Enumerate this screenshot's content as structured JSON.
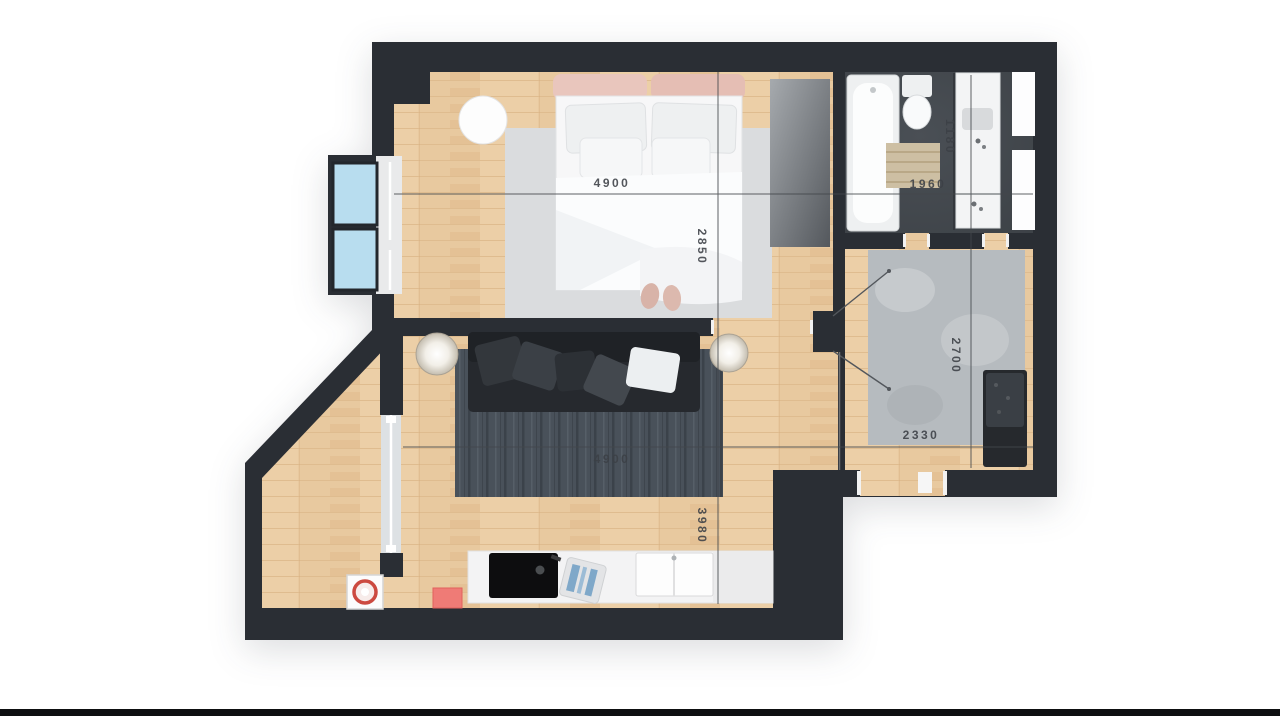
{
  "plan": {
    "title": "apartment-floor-plan",
    "dimensions": {
      "bedroom_width": "4900",
      "bedroom_depth": "2850",
      "bathroom_width": "1960",
      "bathroom_depth": "1180",
      "hallway_width": "2330",
      "hallway_depth": "2700",
      "living_width": "4900",
      "living_depth": "3980"
    },
    "colors": {
      "wall": "#2a2e34",
      "wood_floor": "#e8c99f",
      "bathroom_tile": "#43484d",
      "bedroom_rug": "#dadcde",
      "living_rug": "#49515a",
      "hall_rug": "#b6bbbf",
      "window_glass": "#b8ddef",
      "accent_mat": "#ef7b76",
      "washer_ring": "#cc4a40",
      "dimension_text": "#3c4046"
    },
    "fixtures": [
      "double-bed",
      "bedside-pouf",
      "wardrobe",
      "window-bay",
      "bathtub",
      "toilet",
      "bath-mat",
      "vanity-counter",
      "hall-rug",
      "shoe-cabinet",
      "sofa",
      "living-rug",
      "floor-lamps",
      "kitchen-counter",
      "cooktop",
      "kitchen-sink",
      "cutting-board",
      "entry-mat",
      "washer",
      "glass-partition"
    ]
  }
}
